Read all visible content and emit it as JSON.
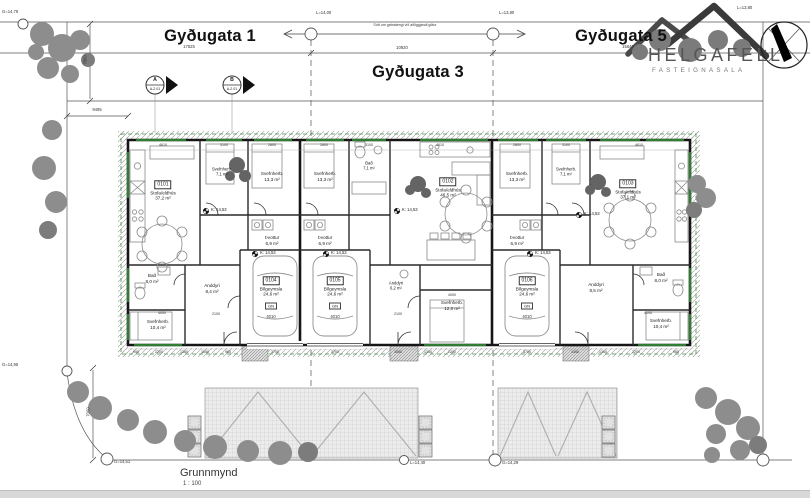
{
  "drawing": {
    "title": "Grunnmynd",
    "scale": "1 : 100",
    "note": "Sótt um gatnatengi við aðliggjandi götur"
  },
  "logo": {
    "name": "HELGAFELL",
    "subtitle": "FASTEIGNASALA"
  },
  "streets": {
    "s1": {
      "label": "Gyðugata 1",
      "dim": "17525"
    },
    "s3": {
      "label": "Gyðugata 3",
      "dim": "10920"
    },
    "s5": {
      "label": "Gyðugata 5",
      "dim": "15640"
    }
  },
  "markers": {
    "top_left": "G=14,79",
    "street1": "L=14,00",
    "street2": "L=13,80",
    "top_right": "L=13,80",
    "left": "G=14,95",
    "bottom1": "G=14,51",
    "bottom2": "L=14,40",
    "bottom3": "G=14,29"
  },
  "sections": {
    "a": {
      "letter": "A",
      "sheet": "A-2.01"
    },
    "b": {
      "letter": "B",
      "sheet": "A-2.01"
    }
  },
  "level": "K: 14,53",
  "site_dims": {
    "v_top": "7800",
    "h_left": "9495",
    "v_bottom": "7000"
  },
  "units": {
    "u1": {
      "id": "0101",
      "living": {
        "name": "Stofa/eldhús",
        "area": "37,2 m²"
      },
      "bed_small": {
        "name": "Svefnherb.",
        "area": "7,1 m²"
      },
      "bed_large": {
        "name": "Svefnherb.",
        "area": "13,3 m²"
      },
      "laundry": {
        "name": "Þvottur",
        "area": "6,9 m²"
      },
      "bath": {
        "name": "Bað",
        "area": "8,0 m²"
      },
      "entry": {
        "name": "Anddyri",
        "area": "8,4 m²"
      },
      "bed_lower": {
        "name": "Svefnherb.",
        "area": "10,4 m²"
      }
    },
    "u2": {
      "id": "0102",
      "living": {
        "name": "Stofa/eldhús",
        "area": "46,5 m²"
      },
      "bed_large": {
        "name": "Svefnherb.",
        "area": "13,3 m²"
      },
      "bath": {
        "name": "Bað",
        "area": "7,1 m²"
      },
      "laundry": {
        "name": "Þvottur",
        "area": "6,9 m²"
      },
      "entry": {
        "name": "Anddyri",
        "area": "6,2 m²"
      },
      "bed_lower": {
        "name": "Svefnherb.",
        "area": "12,0 m²"
      }
    },
    "u3": {
      "id": "0103",
      "living": {
        "name": "Stofa/eldhús",
        "area": "37,1 m²"
      },
      "bed_large": {
        "name": "Svefnherb.",
        "area": "13,3 m²"
      },
      "bed_small": {
        "name": "Svefnherb.",
        "area": "7,1 m²"
      },
      "laundry": {
        "name": "Þvottur",
        "area": "6,9 m²"
      },
      "bath": {
        "name": "Bað",
        "area": "8,0 m²"
      },
      "entry": {
        "name": "Anddyri",
        "area": "8,5 m²"
      },
      "bed_lower": {
        "name": "Svefnherb.",
        "area": "10,4 m²"
      }
    }
  },
  "garages": {
    "name": "Bílgeymsla",
    "area": "24,6 m²",
    "gn": "GN",
    "door": "4010",
    "g1": "0104",
    "g2": "0105",
    "g3": "0106"
  },
  "dims": {
    "top": [
      "4610",
      "3100",
      "2800",
      "2800",
      "3100",
      "4610",
      "2800",
      "3100",
      "4610"
    ],
    "bottom": [
      "950",
      "2200",
      "1360",
      "1650",
      "960",
      "3700",
      "3700",
      "1650",
      "1360",
      "2200",
      "3700",
      "1450",
      "1360",
      "2200",
      "950"
    ],
    "rooms": [
      "4000",
      "2100",
      "2100",
      "4000",
      "4000"
    ]
  }
}
